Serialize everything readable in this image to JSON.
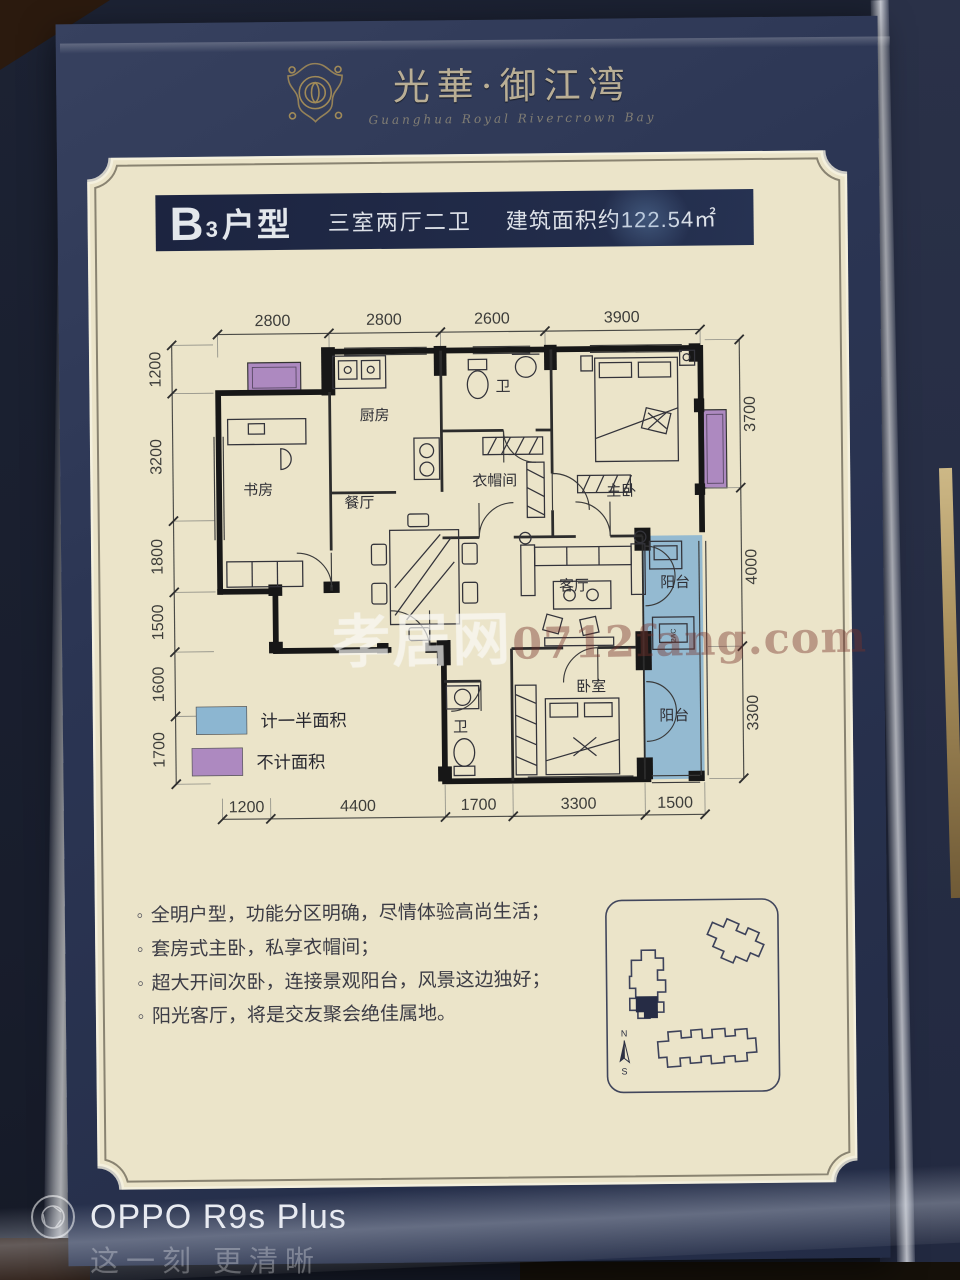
{
  "header": {
    "brand": "光華·御江湾",
    "brand_sub": "Guanghua Royal Rivercrown Bay"
  },
  "titlebar": {
    "unit_main": "B",
    "unit_sub": "3",
    "unit_word": "户型",
    "layout": "三室两厅二卫",
    "area": "建筑面积约122.54㎡"
  },
  "plan": {
    "rooms": {
      "study": "书房",
      "kitchen": "厨房",
      "dining": "餐厅",
      "bath1": "卫",
      "cloak": "衣帽间",
      "master": "主卧",
      "living": "客厅",
      "balcony1": "阳台",
      "bedroom": "卧室",
      "bath2": "卫",
      "balcony2": "阳台",
      "ac": "2AC"
    },
    "dims": {
      "top": [
        "2800",
        "2800",
        "2600",
        "3900"
      ],
      "bottom": [
        "1200",
        "4400",
        "1700",
        "3300",
        "1500"
      ],
      "left": [
        "1200",
        "3200",
        "1800",
        "1500",
        "1600",
        "1700"
      ],
      "right": [
        "3700",
        "4000",
        "3300"
      ]
    },
    "legend": [
      {
        "color": "#8cb6d1",
        "label": "计一半面积"
      },
      {
        "color": "#ad89c0",
        "label": "不计面积"
      }
    ]
  },
  "features": {
    "bullet": "◦",
    "items": [
      "全明户型，功能分区明确，尽情体验高尚生活；",
      "套房式主卧，私享衣帽间；",
      "超大开间次卧，连接景观阳台，风景这边独好；",
      "阳光客厅，将是交友聚会绝佳属地。"
    ]
  },
  "siteplan": {
    "north": "N",
    "south": "S"
  },
  "watermark": {
    "site_name": "孝居网",
    "site_url": "0712fang.com",
    "camera_model": "OPPO R9s Plus",
    "camera_slogan": "这一刻 更清晰"
  },
  "colors": {
    "page_navy": "#2b3553",
    "panel_cream": "#ebe4c9",
    "title_navy": "#1f2842",
    "half_area_blue": "#8cb6d1",
    "no_area_purple": "#ad89c0",
    "brand_gold": "#b9ae95"
  }
}
